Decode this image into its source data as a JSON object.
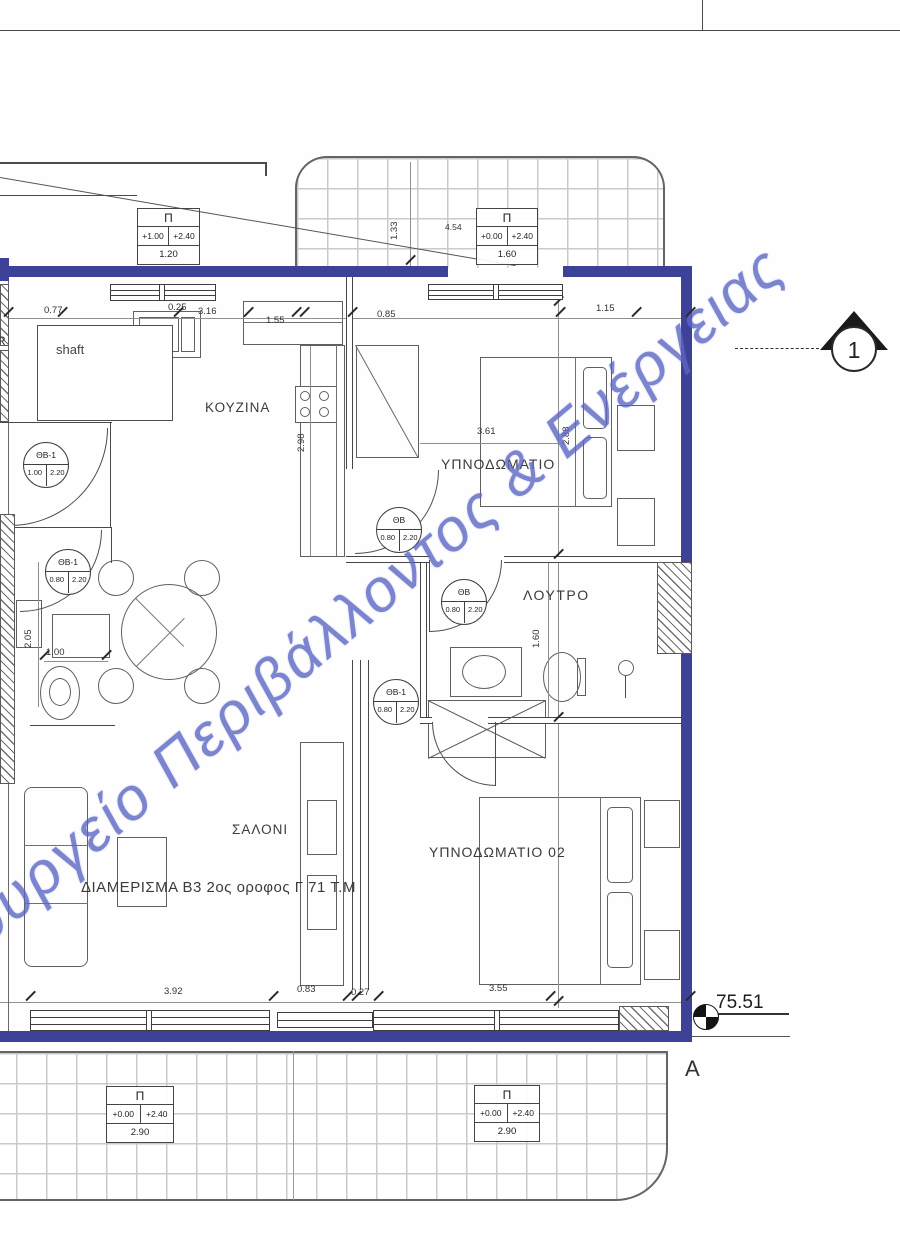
{
  "drawing": {
    "apartment_label": "ΔΙΑΜΕΡΙΣΜΑ Β3 2ος οροφος Γ 71 Τ.Μ",
    "watermark": "ουργείο Περιβάλλοντος & Ενέργειας",
    "edge_label": "R"
  },
  "rooms": {
    "kitchen": "ΚΟΥΖΙΝΑ",
    "bedroom1": "ΥΠΝΟΔΩΜΑΤΙΟ",
    "bathroom": "ΛΟΥΤΡΟ",
    "living": "ΣΑΛΟΝΙ",
    "bedroom2": "ΥΠΝΟΔΩΜΑΤΙΟ 02",
    "shaft": "shaft"
  },
  "door_tags": [
    {
      "name": "ΘΒ-1",
      "w": "1.00",
      "h": "2.20"
    },
    {
      "name": "ΘΒ-1",
      "w": "0.80",
      "h": "2.20"
    },
    {
      "name": "ΘΒ",
      "w": "0.80",
      "h": "2.20"
    },
    {
      "name": "ΘΒ",
      "w": "0.80",
      "h": "2.20"
    },
    {
      "name": "ΘΒ-1",
      "w": "0.80",
      "h": "2.20"
    }
  ],
  "opening_tables": [
    {
      "symbol": "Π",
      "sill": "+1.00",
      "head": "+2.40",
      "width": "1.20"
    },
    {
      "symbol": "Π",
      "sill": "+0.00",
      "head": "+2.40",
      "width": "1.60"
    },
    {
      "symbol": "Π",
      "sill": "+0.00",
      "head": "+2.40",
      "width": "2.90"
    },
    {
      "symbol": "Π",
      "sill": "+0.00",
      "head": "+2.40",
      "width": "2.90"
    }
  ],
  "dims": {
    "top_1": "0.77",
    "top_2": "0.25",
    "top_3": "3.16",
    "top_4": "1.55",
    "top_5": "0.85",
    "top_6": "1.15",
    "v_133": "1.33",
    "h_454": "4.54",
    "v_298": "2.98",
    "h_361": "3.61",
    "v_288": "2.88",
    "v_160": "1.60",
    "v_205": "2.05",
    "h_100": "1.00",
    "bot_1": "3.92",
    "bot_2": "0.83",
    "bot_3": "0.27",
    "bot_4": "3.55"
  },
  "markers": {
    "level": "75.51",
    "section": "1",
    "grid_letter": "A"
  },
  "colors": {
    "wall": "#3e4198",
    "watermark": "#5b66c4"
  }
}
